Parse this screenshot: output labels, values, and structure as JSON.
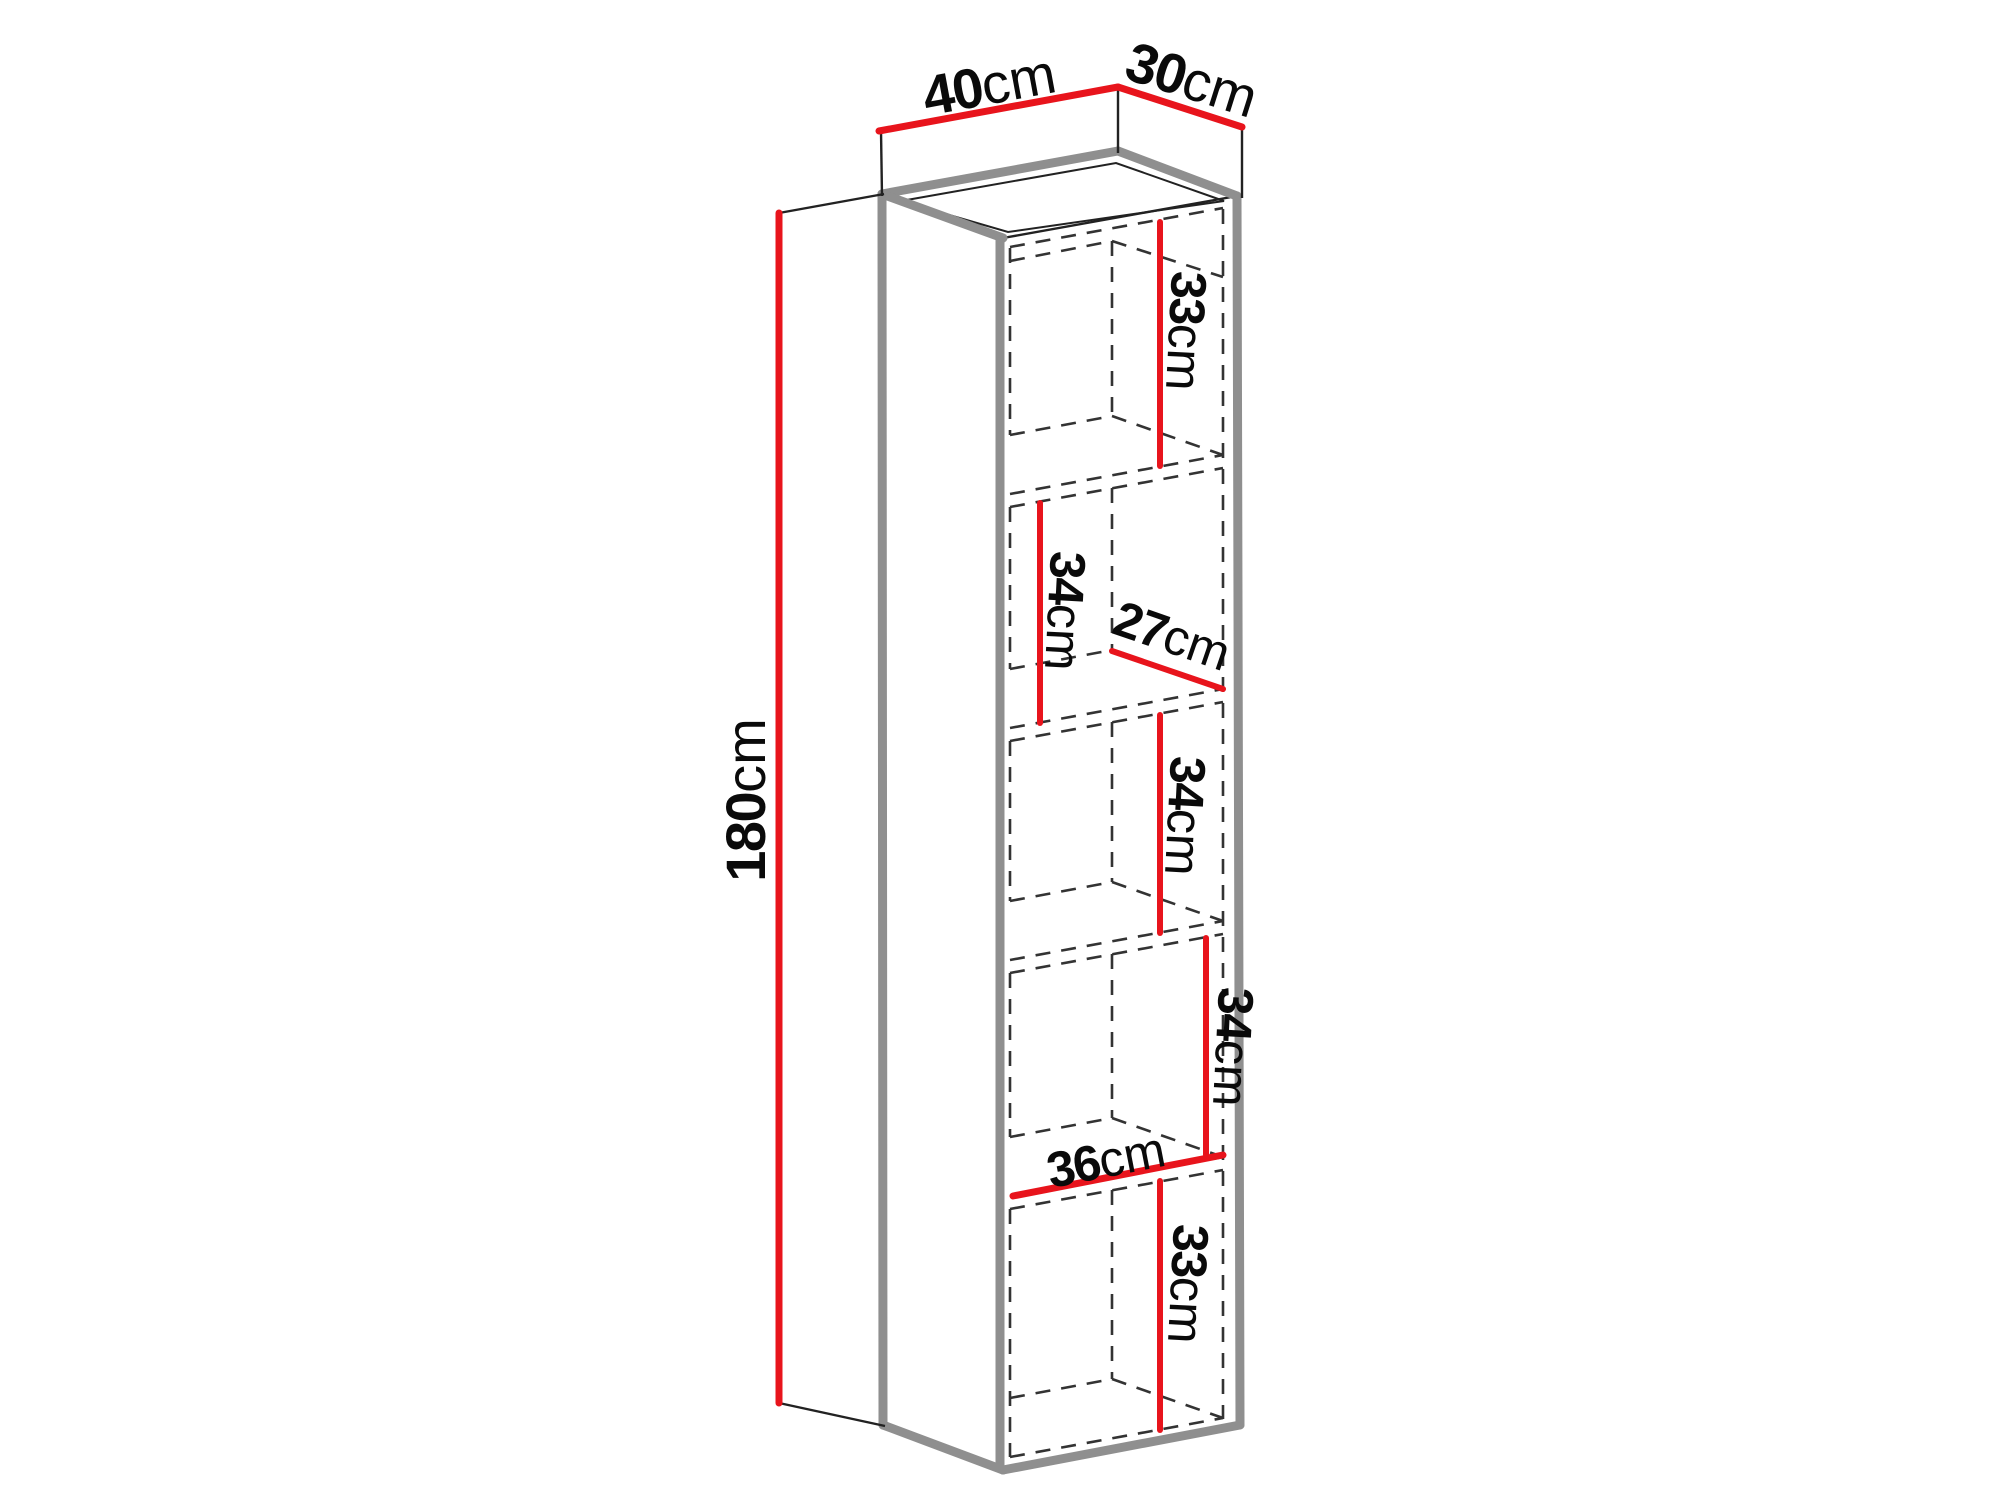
{
  "diagram": {
    "type": "furniture-dimension-diagram",
    "units": "cm",
    "overall_dimensions": {
      "height": "180cm",
      "width": "40cm",
      "depth": "30cm"
    },
    "internal_dimensions": {
      "compartment_heights": [
        "33cm",
        "34cm",
        "34cm",
        "34cm",
        "33cm"
      ],
      "internal_depth": "27cm",
      "internal_width": "36cm"
    }
  },
  "colors": {
    "background": "#ffffff",
    "dimension_red": "#e8141c",
    "edge_gray": "#8f8f8f",
    "thin_line": "#222222",
    "dashed_line": "#333333",
    "text": "#0a0a0a"
  },
  "geometry": {
    "faces": [
      {
        "name": "cabinet-top-face",
        "points": [
          [
            882,
            194
          ],
          [
            1118,
            151
          ],
          [
            1237,
            196
          ],
          [
            1003,
            238
          ]
        ]
      },
      {
        "name": "cabinet-left-face",
        "points": [
          [
            882,
            194
          ],
          [
            1003,
            238
          ],
          [
            1003,
            1470
          ],
          [
            883,
            1425
          ]
        ]
      },
      {
        "name": "cabinet-front-face",
        "points": [
          [
            1003,
            238
          ],
          [
            1237,
            196
          ],
          [
            1240,
            1425
          ],
          [
            1003,
            1470
          ]
        ]
      }
    ],
    "top_inset": [
      [
        901,
        201
      ],
      [
        1116,
        163
      ],
      [
        1224,
        201
      ],
      [
        1008,
        232
      ]
    ],
    "thin_edges": [
      [
        [
          1003,
          238
        ],
        [
          1237,
          196
        ]
      ]
    ],
    "thick_edges": [
      [
        [
          882,
          194
        ],
        [
          1118,
          151
        ]
      ],
      [
        [
          1118,
          151
        ],
        [
          1237,
          196
        ]
      ],
      [
        [
          882,
          194
        ],
        [
          1003,
          238
        ]
      ],
      [
        [
          882,
          194
        ],
        [
          883,
          1425
        ]
      ],
      [
        [
          883,
          1425
        ],
        [
          1003,
          1470
        ]
      ],
      [
        [
          1003,
          1470
        ],
        [
          1240,
          1425
        ]
      ],
      [
        [
          1237,
          196
        ],
        [
          1240,
          1425
        ]
      ],
      [
        [
          1000,
          240
        ],
        [
          1000,
          1468
        ]
      ]
    ],
    "dashed_segments": [
      [
        [
          1010,
          247
        ],
        [
          1223,
          208
        ]
      ],
      [
        [
          1010,
          261
        ],
        [
          1112,
          241
        ]
      ],
      [
        [
          1112,
          241
        ],
        [
          1223,
          277
        ]
      ],
      [
        [
          1010,
          248
        ],
        [
          1010,
          435
        ]
      ],
      [
        [
          1010,
          507
        ],
        [
          1010,
          669
        ]
      ],
      [
        [
          1010,
          741
        ],
        [
          1010,
          901
        ]
      ],
      [
        [
          1010,
          973
        ],
        [
          1010,
          1137
        ]
      ],
      [
        [
          1010,
          1209
        ],
        [
          1010,
          1457
        ]
      ],
      [
        [
          1112,
          241
        ],
        [
          1112,
          416
        ]
      ],
      [
        [
          1112,
          488
        ],
        [
          1112,
          650
        ]
      ],
      [
        [
          1112,
          722
        ],
        [
          1112,
          882
        ]
      ],
      [
        [
          1112,
          954
        ],
        [
          1112,
          1118
        ]
      ],
      [
        [
          1112,
          1190
        ],
        [
          1112,
          1379
        ]
      ],
      [
        [
          1223,
          209
        ],
        [
          1223,
          1419
        ]
      ],
      [
        [
          1010,
          494
        ],
        [
          1223,
          455
        ]
      ],
      [
        [
          1010,
          507
        ],
        [
          1223,
          468
        ]
      ],
      [
        [
          1010,
          435
        ],
        [
          1112,
          416
        ]
      ],
      [
        [
          1112,
          416
        ],
        [
          1223,
          455
        ]
      ],
      [
        [
          1010,
          728
        ],
        [
          1223,
          689
        ]
      ],
      [
        [
          1010,
          741
        ],
        [
          1223,
          702
        ]
      ],
      [
        [
          1010,
          669
        ],
        [
          1112,
          650
        ]
      ],
      [
        [
          1112,
          650
        ],
        [
          1223,
          689
        ]
      ],
      [
        [
          1010,
          960
        ],
        [
          1223,
          921
        ]
      ],
      [
        [
          1010,
          973
        ],
        [
          1223,
          934
        ]
      ],
      [
        [
          1010,
          901
        ],
        [
          1112,
          882
        ]
      ],
      [
        [
          1112,
          882
        ],
        [
          1223,
          921
        ]
      ],
      [
        [
          1010,
          1196
        ],
        [
          1223,
          1157
        ]
      ],
      [
        [
          1010,
          1209
        ],
        [
          1223,
          1170
        ]
      ],
      [
        [
          1010,
          1137
        ],
        [
          1112,
          1118
        ]
      ],
      [
        [
          1112,
          1118
        ],
        [
          1223,
          1157
        ]
      ],
      [
        [
          1010,
          1457
        ],
        [
          1223,
          1418
        ]
      ],
      [
        [
          1010,
          1398
        ],
        [
          1112,
          1379
        ]
      ],
      [
        [
          1112,
          1379
        ],
        [
          1223,
          1418
        ]
      ]
    ]
  },
  "dimension_annotations": [
    {
      "id": "height",
      "value": "180",
      "unit": "cm",
      "kind": "outer",
      "line": [
        [
          779,
          213
        ],
        [
          779,
          1403
        ]
      ],
      "line_width": 7,
      "extensions": [
        [
          [
            779,
            213
          ],
          [
            884,
            194
          ]
        ],
        [
          [
            779,
            1403
          ],
          [
            885,
            1426
          ]
        ]
      ],
      "label": {
        "x": 745,
        "y": 800,
        "rot": -90
      }
    },
    {
      "id": "width",
      "value": "40",
      "unit": "cm",
      "kind": "outer",
      "line": [
        [
          879,
          131
        ],
        [
          1118,
          87
        ]
      ],
      "line_width": 7,
      "extensions": [
        [
          [
            881,
            131
          ],
          [
            882,
            196
          ]
        ],
        [
          [
            1118,
            87
          ],
          [
            1118,
            153
          ]
        ]
      ],
      "label": {
        "x": 989,
        "y": 84,
        "rot": -10.5
      }
    },
    {
      "id": "depth",
      "value": "30",
      "unit": "cm",
      "kind": "outer",
      "line": [
        [
          1118,
          87
        ],
        [
          1242,
          127
        ]
      ],
      "line_width": 7,
      "extensions": [
        [
          [
            1242,
            127
          ],
          [
            1242,
            198
          ]
        ]
      ],
      "label": {
        "x": 1192,
        "y": 79,
        "rot": 17.5
      }
    },
    {
      "id": "compartment-1-height",
      "value": "33",
      "unit": "cm",
      "kind": "inner",
      "line": [
        [
          1160,
          222
        ],
        [
          1160,
          466
        ]
      ],
      "line_width": 6,
      "extensions": [],
      "label": {
        "x": 1186,
        "y": 331,
        "rot": 93
      }
    },
    {
      "id": "compartment-2-height",
      "value": "34",
      "unit": "cm",
      "kind": "inner",
      "line": [
        [
          1040,
          503
        ],
        [
          1040,
          723
        ]
      ],
      "line_width": 6,
      "extensions": [],
      "label": {
        "x": 1065,
        "y": 611,
        "rot": 93
      }
    },
    {
      "id": "internal-depth",
      "value": "27",
      "unit": "cm",
      "kind": "inner",
      "line": [
        [
          1112,
          651
        ],
        [
          1223,
          689
        ]
      ],
      "line_width": 6,
      "extensions": [],
      "label": {
        "x": 1172,
        "y": 636,
        "rot": 19
      }
    },
    {
      "id": "compartment-3-height",
      "value": "34",
      "unit": "cm",
      "kind": "inner",
      "line": [
        [
          1160,
          715
        ],
        [
          1160,
          933
        ]
      ],
      "line_width": 6,
      "extensions": [],
      "label": {
        "x": 1185,
        "y": 816,
        "rot": 93
      }
    },
    {
      "id": "compartment-4-height",
      "value": "34",
      "unit": "cm",
      "kind": "inner",
      "line": [
        [
          1206,
          938
        ],
        [
          1206,
          1155
        ]
      ],
      "line_width": 6,
      "extensions": [],
      "label": {
        "x": 1233,
        "y": 1047,
        "rot": 93
      }
    },
    {
      "id": "internal-width",
      "value": "36",
      "unit": "cm",
      "kind": "inner",
      "line": [
        [
          1013,
          1196
        ],
        [
          1223,
          1155
        ]
      ],
      "line_width": 7,
      "extensions": [],
      "label": {
        "x": 1106,
        "y": 1160,
        "rot": -11
      }
    },
    {
      "id": "compartment-5-height",
      "value": "33",
      "unit": "cm",
      "kind": "inner",
      "line": [
        [
          1160,
          1181
        ],
        [
          1160,
          1430
        ]
      ],
      "line_width": 6,
      "extensions": [],
      "label": {
        "x": 1188,
        "y": 1284,
        "rot": 93
      }
    }
  ]
}
